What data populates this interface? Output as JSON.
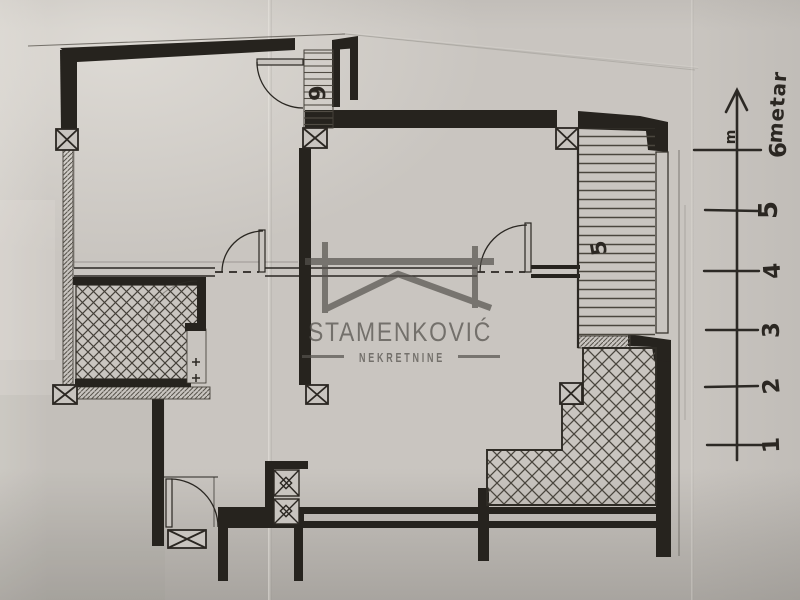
{
  "watermark": {
    "brand": "STAMENKOVIĆ",
    "tagline": "NEKRETNINE",
    "color": "#55524d"
  },
  "scale_ruler": {
    "unit_label": "metar",
    "axis_abbr": "m",
    "ticks": [
      "1",
      "2",
      "3",
      "4",
      "5",
      "6"
    ]
  },
  "plan_labels": {
    "entry_stairs_count": "9",
    "loggia_number": "5"
  },
  "colors": {
    "ink": "#26231e",
    "paper": "#c9c5c0",
    "watermark_gray": "#55524d"
  }
}
